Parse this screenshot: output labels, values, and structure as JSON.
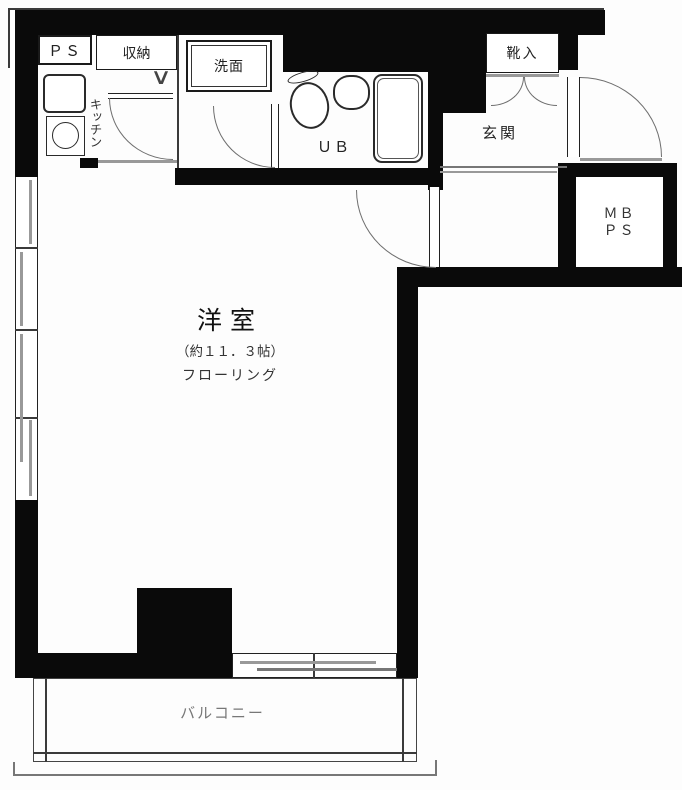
{
  "plan_title": "apartment-floor-plan",
  "rooms": {
    "ps": "ＰＳ",
    "storage": "収納",
    "washbasin": "洗面",
    "kitchen": "キッチン",
    "unit_bath": "ＵＢ",
    "shoe_box": "靴入",
    "entrance": "玄関",
    "meter_box_line1": "ＭＢ",
    "meter_box_line2": "ＰＳ",
    "main_room": "洋室",
    "main_room_size": "（約１１．３帖）",
    "main_room_floor": "フローリング",
    "balcony": "バルコニー"
  },
  "marks": {
    "folding_door": "∨"
  },
  "colors": {
    "wall": "#0a0a0a",
    "thin_line": "#3a3a3a",
    "door_arc": "#6e6e6e",
    "sash_gray": "#999999",
    "balcony_text": "#777777",
    "background": "#fdfdfd"
  }
}
